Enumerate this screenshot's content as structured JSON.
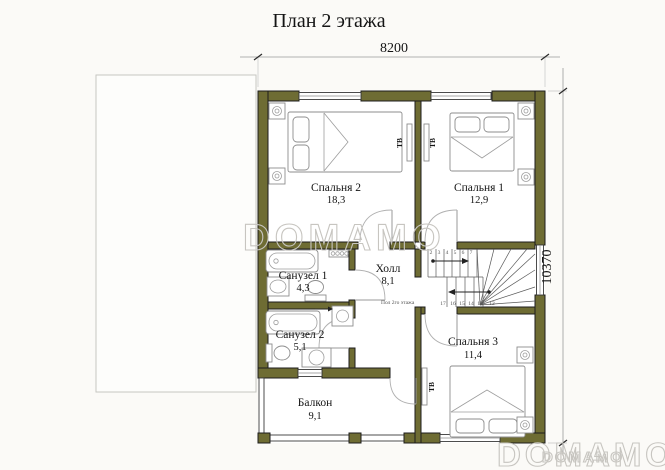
{
  "title": "План 2 этажа",
  "dimensions": {
    "top": "8200",
    "right": "10370"
  },
  "rooms": [
    {
      "name": "Спальня 2",
      "area": "18,3"
    },
    {
      "name": "Спальня 1",
      "area": "12,9"
    },
    {
      "name": "Санузел 1",
      "area": "4,3"
    },
    {
      "name": "Холл",
      "area": "8,1"
    },
    {
      "name": "Санузел 2",
      "area": "5,1"
    },
    {
      "name": "Спальня 3",
      "area": "11,4"
    },
    {
      "name": "Балкон",
      "area": "9,1"
    }
  ],
  "annotations": {
    "tv": "ТВ",
    "stair_note": "Пол 2го этажа",
    "stair_step_numbers": [
      "2",
      "3",
      "4",
      "5",
      "6",
      "7"
    ],
    "stair_lower_numbers": [
      "17",
      "16",
      "15",
      "14",
      "13",
      "12"
    ]
  },
  "watermark": {
    "text": "DOMAMO"
  },
  "colors": {
    "wall": "#6e6c33",
    "outline": "#1d1d1d",
    "furniture_line": "#8d8d8d",
    "dimension_line": "#9a9a9a",
    "background": "#fbfaf7"
  }
}
